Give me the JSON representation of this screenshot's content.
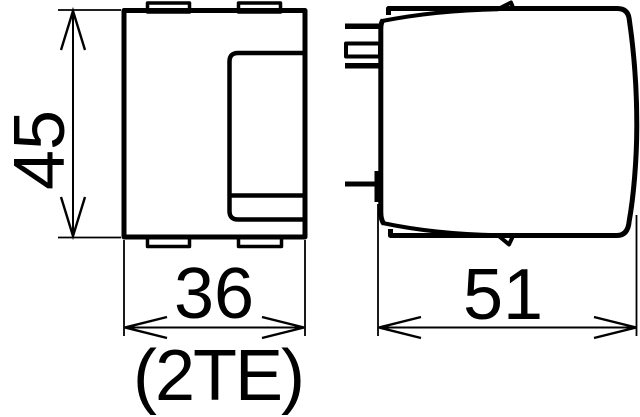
{
  "drawing": {
    "kind": "technical-dimension-drawing",
    "colors": {
      "line": "#000000",
      "background": "#ffffff"
    },
    "dimensions": {
      "height": {
        "value": "45"
      },
      "width": {
        "value": "36",
        "units": "(2TE)"
      },
      "depth": {
        "value": "51"
      }
    }
  }
}
